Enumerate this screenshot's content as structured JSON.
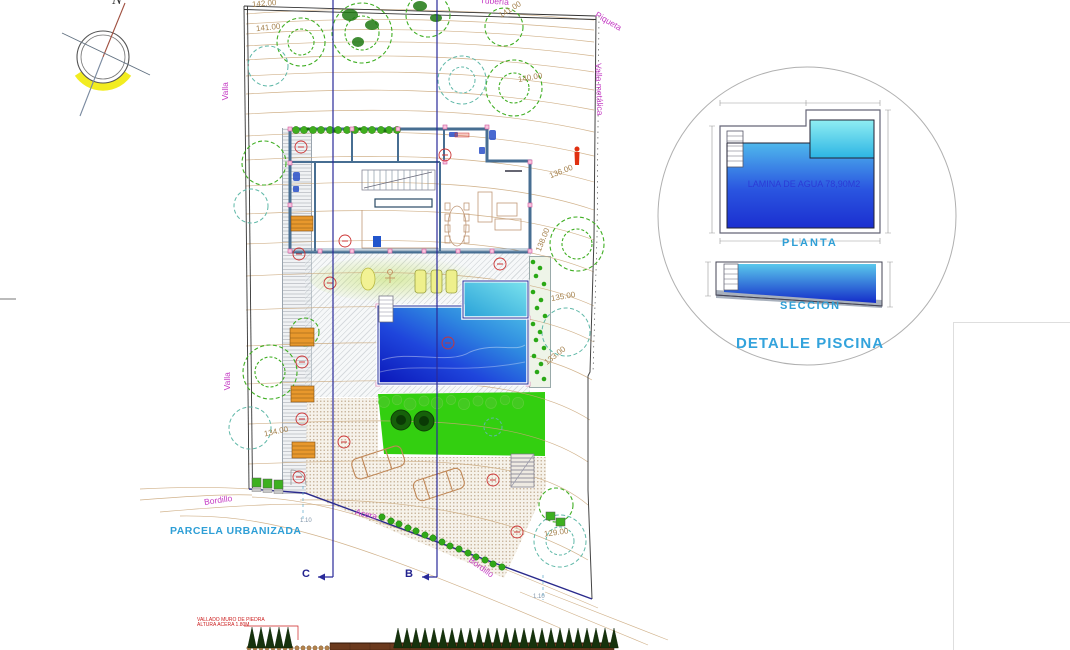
{
  "compass": {
    "north": "N"
  },
  "site": {
    "labels": {
      "valla_top": "Valla",
      "valla_bottom": "Valla",
      "valla_metalica": "Valla metálica",
      "piqueta": "Piqueta",
      "tuberia": "Tubería",
      "bordillo_left": "Bordillo",
      "bordillo_diag": "Bordillo",
      "acera": "Acera",
      "parcela": "PARCELA URBANIZADA",
      "dim_c": "1.10",
      "dim_b": "1.10",
      "section_c": "C",
      "section_b": "B"
    },
    "contour_labels": [
      "142.00",
      "141.00",
      "141.00",
      "140.00",
      "138.00",
      "136.00",
      "135.00",
      "134.00",
      "133.00",
      "129.00"
    ]
  },
  "detail": {
    "title": "DETALLE PISCINA",
    "plan_label": "PLANTA",
    "section_label": "SECCION",
    "water_area": "LAMINA DE AGUA 78,90M2"
  },
  "elevation_note": {
    "line1": "VALLADO MURO DE PIEDRA",
    "line2": "ALTURA ACERA 1.80M"
  },
  "colors": {
    "magenta": "#c43bc4",
    "contour": "#a5824e",
    "cyan_text": "#2f9fd6",
    "section_navy": "#23238f",
    "pool_deep": "#0a16b8",
    "pool_light": "#4fc2e8",
    "lawn": "#33cf10",
    "compass_yellow": "#f2ec20",
    "wall_blue": "#476e92"
  }
}
